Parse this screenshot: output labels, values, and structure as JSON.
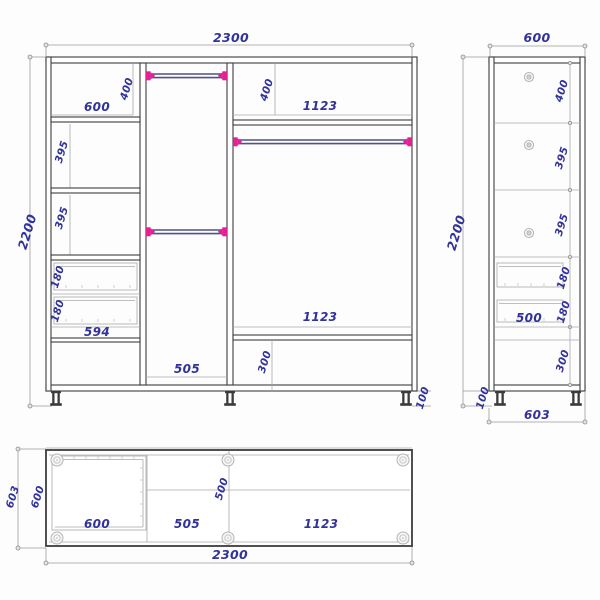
{
  "front_view": {
    "total_width": "2300",
    "total_height": "2200",
    "top_left_width": "600",
    "top_left_height": "400",
    "shelf_a_height": "395",
    "shelf_b_height": "395",
    "drawer_a_height": "180",
    "drawer_b_height": "180",
    "drawer_unit_width": "594",
    "door_width": "505",
    "top_right_height": "400",
    "top_right_width": "1123",
    "bottom_right_width": "1123",
    "bottom_section_height": "300",
    "leg_height": "100"
  },
  "side_view": {
    "depth_top": "600",
    "total_height": "2200",
    "section_1_height": "400",
    "section_2_height": "395",
    "section_3_height": "395",
    "drawer_a_height": "180",
    "drawer_b_height": "180",
    "drawer_depth": "500",
    "bottom_section_height": "300",
    "leg_height": "100",
    "depth_bottom": "603"
  },
  "plan_view": {
    "depth_outer": "603",
    "depth_inner": "600",
    "left_section_width": "600",
    "middle_section_width": "505",
    "right_section_width": "1123",
    "shelf_depth": "500",
    "total_width": "2300"
  },
  "colors": {
    "dimension_text": "#32329b",
    "rod_end_cap": "#e52097",
    "carcass_line": "#3d3d3d"
  }
}
